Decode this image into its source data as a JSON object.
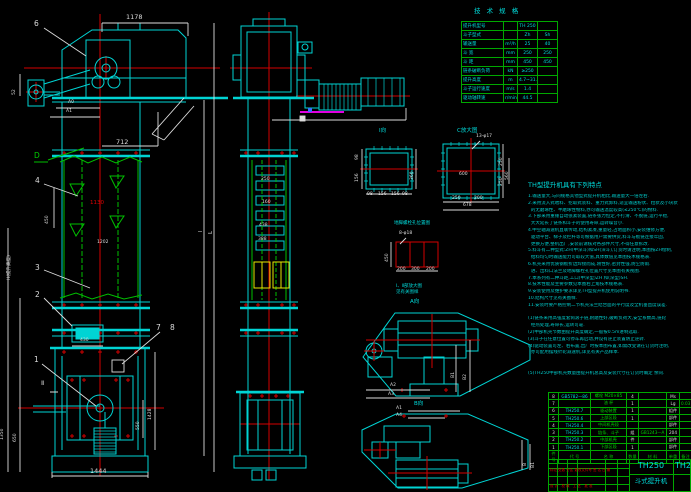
{
  "drawing": {
    "front": {
      "dims": {
        "top": "1178",
        "mid": "712",
        "left_small": "52",
        "a0": "A0",
        "a1": "A1",
        "pitch": "450",
        "red_mid": "1130",
        "flange": "1202",
        "door": "430",
        "boot_h": "1428",
        "boot_inner": "550",
        "base": "1444",
        "left_outer": "1350",
        "left_inner": "650",
        "height_note": "H(提升高度)",
        "l1": "l",
        "l2": "L",
        "section": "Ⅱ"
      },
      "balloons": {
        "b1": "1",
        "b2": "2",
        "b3": "3",
        "b4": "4",
        "b6": "6",
        "b7": "7",
        "b8": "8",
        "d": "D"
      }
    },
    "side": {
      "dims": {
        "d1": "250",
        "d2": "160",
        "d3": "438",
        "d4": "388"
      }
    },
    "details": {
      "flange_i": {
        "label": "Ⅰ向",
        "right": "360",
        "left_top": "98",
        "left_bot": "156",
        "b1": "98",
        "b2": "156",
        "b3": "156",
        "b4": "98"
      },
      "flange_c": {
        "label": "C放大图",
        "callout": "13-φ17",
        "inner": "600",
        "r1": "250",
        "r2": "250",
        "r3": "560",
        "b1": "250",
        "b2": "200",
        "b3": "678"
      },
      "anchor": {
        "title": "地脚螺栓孔位置图",
        "callout": "8-φ18",
        "v": "450",
        "b1": "200",
        "b2": "300",
        "b3": "200",
        "note1": "Ⅰ、Ⅱ部放大图",
        "note2": "见有关图样"
      },
      "view_a": {
        "label": "A向",
        "r1": "B1",
        "r2": "B2",
        "b1": "A2",
        "b2": "A3"
      },
      "view_b": {
        "label": "B向",
        "t1": "A1",
        "t2": "A4",
        "r1": "B",
        "r2": "B1"
      }
    }
  },
  "spec": {
    "title": "技 术 规 格",
    "rows": [
      [
        "提升机型号",
        "",
        "TH 250",
        ""
      ],
      [
        "斗子型式",
        "",
        "Zh",
        "Sh"
      ],
      [
        "输送量",
        "m³/h",
        "25",
        "40"
      ],
      [
        "斗  宽",
        "mm",
        "250",
        "250"
      ],
      [
        "斗  距",
        "mm",
        "450",
        "450"
      ],
      [
        "链条破断负荷",
        "kN",
        "≥250",
        ""
      ],
      [
        "提升高度",
        "m",
        "4.7~31.7",
        ""
      ],
      [
        "斗子运行速度",
        "m/s",
        "1.4",
        ""
      ],
      [
        "驱动轴转速",
        "r/min",
        "44.5",
        ""
      ]
    ]
  },
  "features": {
    "title": "TH型提升机具有下列特点",
    "lines": [
      "1.输送量大,与同规格其他型式提升机相比,输送量大一倍左右.",
      "2.采用流入式喂料、挖取式装料、重力式卸料,适宜输送粉状、粒状及小块状",
      "  的无磨琢性、半磨琢性物料,亦可输送温度较高(≤250℃)的物料.",
      "3.下部采用重锤自动张紧装置,链条张力恒定,不打滑、不脱链,运行平稳,",
      "  大大延长了链条和斗子的使用寿命,运转噪音小.",
      "4.中空轴减速机直联传动,结构紧凑,重量轻,占地面积小,安装维修方便,",
      "  驱动平台、梯子及栏杆等可根据用户需要供货,料斗与板链连接牢固,",
      "  更换方便,整机出厂,安装前请核对各部件尺寸,不得任意拆改.",
      "5.料斗有二种型式:ZH(中深斗)和SH(深斗),订货时请注明,本图按ZH绘制,",
      "  给料均匀时输送能力可取较大值,具体数值见本图技术规格表.",
      "6.机壳采用优质钢板折边焊接而成,刚性好,密封性强,防尘防雨.",
      "  进、出料口法兰及地脚螺栓孔位置尺寸见本图有关视图.",
      "7.本系列有二种斗距,工口(中深型)ZH 和(深型)SH.",
      "8.技术性能及主要参数见本图右上角技术规格表.",
      "9.安装使用及维护要求详见TH型提升机使用说明书.",
      "10.结构尺寸见有关图样.",
      "11.安装时要严格控制二节机壳法兰结合面的平行度及全机垂直度误差.",
      "",
      "(1)链条采用高强度套筒滚子链,耐磨性好,破断负荷大,安全系数高,链轮",
      "  经热处理,寿命长,运转可靠.",
      "(2)中部机壳节数由提升高度确定,一般按0.5m进制选取.",
      "(3)斗子在任意位置可停车再启动,并设有逆止装置防止逆转.",
      "(4)驱动装置可左、右布置,出厂时按本图布置,如需改变请在订货时注明,",
      "  亦可配用摆线针轮减速机,详见有关产品样本.",
      "",
      "",
      "(5)TH250中部机壳数量由提升机总高及安装尺寸在订货时确定 余同."
    ]
  },
  "bom": {
    "rows": [
      [
        "8",
        "GB5782—86",
        "螺栓 M20×85",
        "4",
        "",
        "Ms",
        ""
      ],
      [
        "7",
        "",
        "油  杯",
        "1",
        "",
        "Lg",
        "0.03"
      ],
      [
        "6",
        "TH250.7",
        "驱动装置",
        "1",
        "",
        "组件",
        ""
      ],
      [
        "5",
        "TH250.6",
        "上部区段",
        "1",
        "",
        "部件",
        ""
      ],
      [
        "4",
        "TH250.4",
        "中间机壳段",
        "",
        "",
        "部件",
        ""
      ],
      [
        "3",
        "TH250.3",
        "链条、斗子",
        "组",
        "GB1243—A",
        "204",
        ""
      ],
      [
        "2",
        "TH250.2",
        "中部机壳",
        "件",
        "",
        "部件",
        ""
      ],
      [
        "1",
        "TH250.1",
        "下部区段",
        "1",
        "",
        "部件",
        ""
      ],
      [
        "件号",
        "代  号",
        "名  称",
        "数量",
        "材  料",
        "单重",
        "备注"
      ]
    ]
  },
  "title_block": {
    "model": "TH250",
    "product": "斗式提升机",
    "sheet": "TH2",
    "sig_row1": "标记 处数 分区 更改文件号 签 名 日 期",
    "sig_row2": "设 计   校 核   工 艺   批 准"
  }
}
